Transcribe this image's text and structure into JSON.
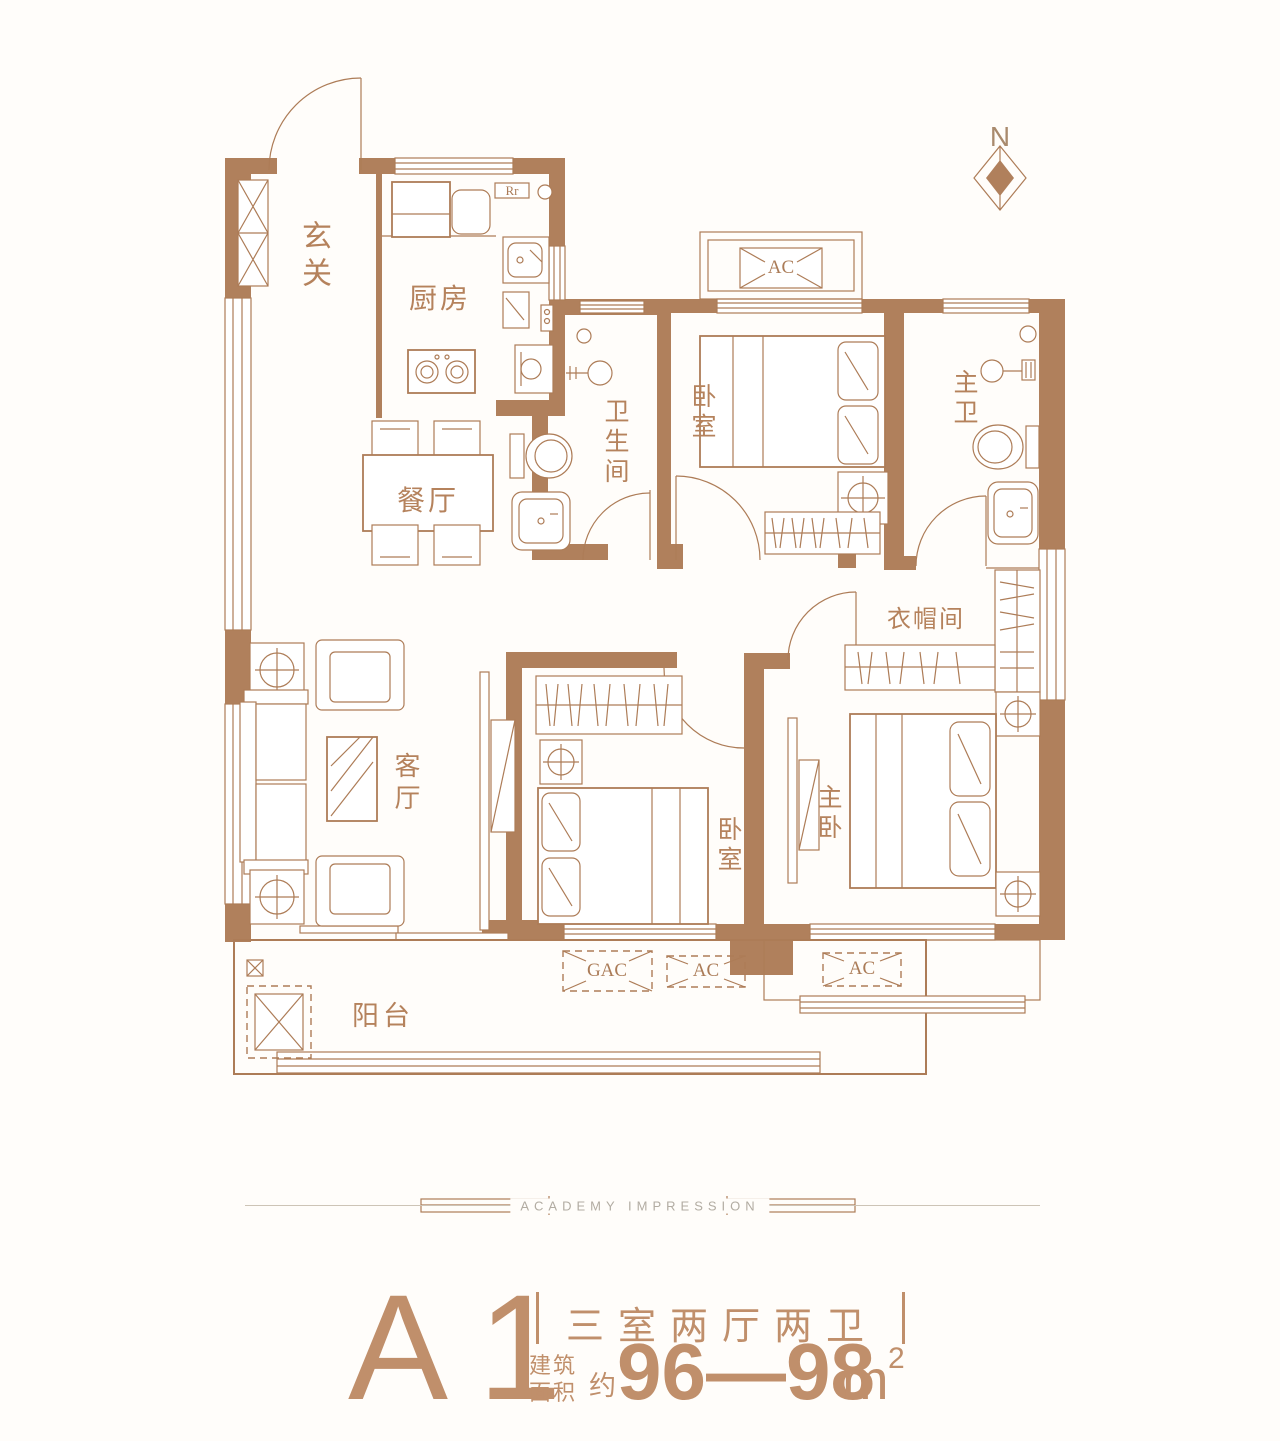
{
  "palette": {
    "wall": "#b0805c",
    "line": "#ad7c57",
    "room_label": "#b5825c",
    "title_text": "#c08f6b",
    "divider_gray": "#b2aca2"
  },
  "compass": {
    "north": "N"
  },
  "rooms": {
    "entrance": "玄关",
    "kitchen": "厨房",
    "dining": "餐厅",
    "bathroom": "卫生间",
    "bedroom_top": "卧室",
    "master_bath": "主卫",
    "closet": "衣帽间",
    "living": "客厅",
    "bedroom_bottom": "卧室",
    "master_bedroom": "主卧",
    "balcony": "阳台"
  },
  "equipment": {
    "fridge_mark": "Rr",
    "ac_platform_top": "AC",
    "balcony_gac": "GAC",
    "balcony_ac": "AC",
    "master_ledge_ac": "AC"
  },
  "divider": {
    "label": "ACADEMY IMPRESSION"
  },
  "title": {
    "unit": "A1",
    "layout": "三室两厅两卫",
    "area_label_line1": "建筑",
    "area_label_line2": "面积",
    "area_approx": "约",
    "area_range": "96—98",
    "area_unit": "m",
    "area_exponent": "2"
  }
}
